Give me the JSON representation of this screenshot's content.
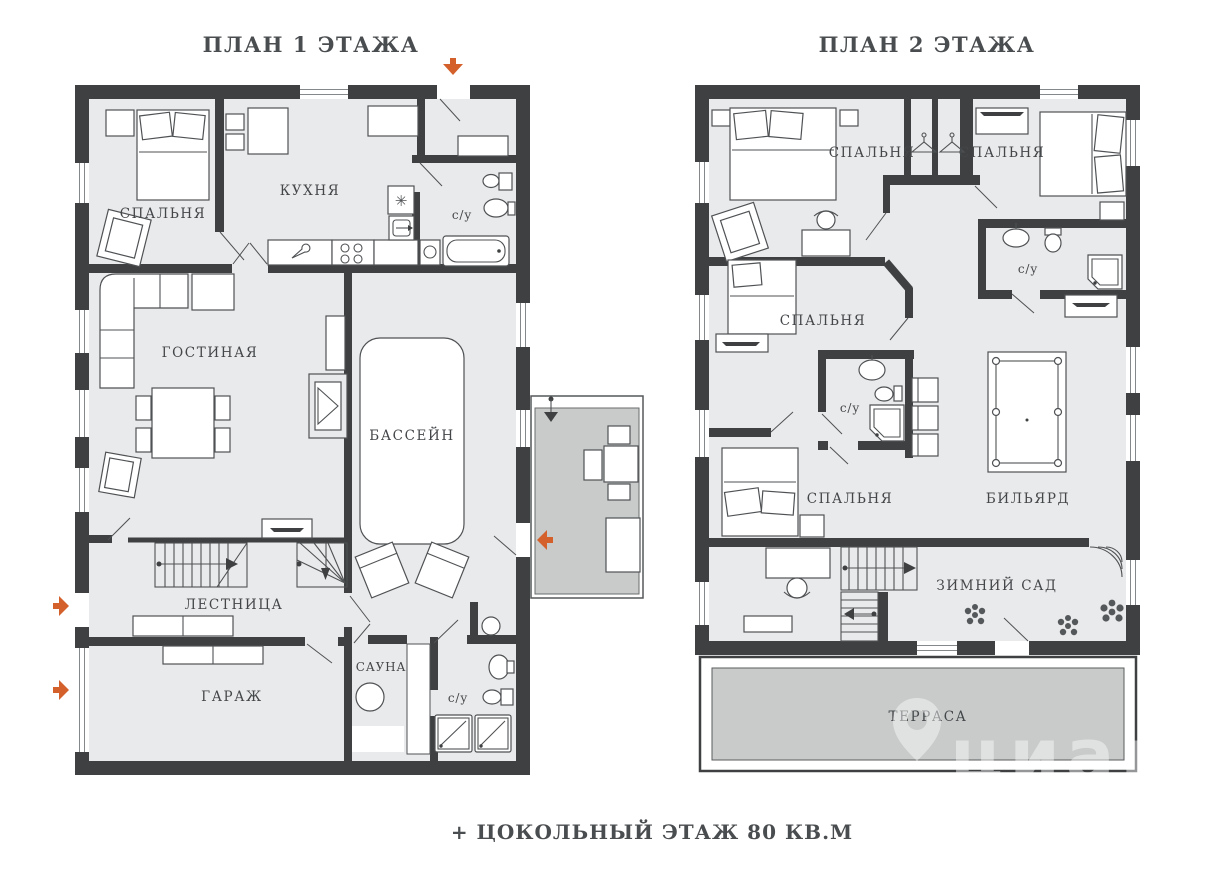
{
  "page": {
    "footer": "+ ЦОКОЛЬНЫЙ ЭТАЖ 80 КВ.М"
  },
  "floor1": {
    "title": "ПЛАН 1 ЭТАЖА",
    "rooms": {
      "bedroom": "СПАЛЬНЯ",
      "kitchen": "КУХНЯ",
      "bathroom_top": "с/у",
      "living_room": "ГОСТИНАЯ",
      "pool": "БАССЕЙН",
      "stairs": "ЛЕСТНИЦА",
      "garage": "ГАРАЖ",
      "sauna": "САУНА",
      "bathroom_bottom": "с/у"
    }
  },
  "floor2": {
    "title": "ПЛАН 2 ЭТАЖА",
    "rooms": {
      "bedroom_1": "СПАЛЬНЯ",
      "bedroom_2": "СПАЛЬНЯ",
      "bathroom_top": "с/у",
      "bedroom_3": "СПАЛЬНЯ",
      "bathroom_mid": "с/у",
      "bedroom_4": "СПАЛЬНЯ",
      "billiards": "БИЛЬЯРД",
      "winter_garden": "ЗИМНИЙ САД",
      "terrace": "ТЕРРАСА"
    }
  },
  "watermark": {
    "brand": "циан"
  },
  "colors": {
    "wall": "#3e4041",
    "room_fill": "#e9eaeb",
    "outdoor_fill": "#c8cbca",
    "accent_arrow": "#d4612c",
    "label_text": "#44474a"
  }
}
